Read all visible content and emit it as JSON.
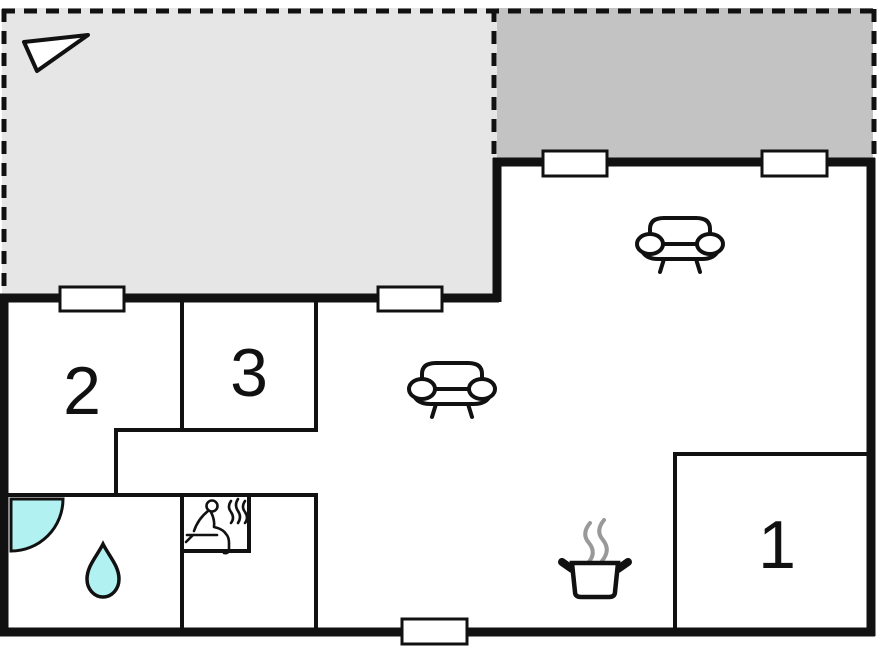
{
  "page": {
    "type": "vacation-house-floor-plan"
  },
  "rooms": [
    {
      "number": "1"
    },
    {
      "number": "2"
    },
    {
      "number": "3"
    }
  ],
  "areas": {
    "terrace_upper_left": "open terrace (light grey, dashed boundary)",
    "terrace_upper_right": "covered terrace (dark grey, dashed boundary)",
    "bathroom": "bathroom with shower and water drop symbols",
    "sauna": "sauna room with sauna bench symbol",
    "living_area": "living area with two sofas",
    "kitchen": "kitchen area with cooking pot symbol"
  },
  "icons": [
    "north-arrow-icon",
    "sofa-icon",
    "sofa-icon",
    "shower-quarter-circle-icon",
    "water-drop-icon",
    "sauna-person-icon",
    "heat-waves-icon",
    "cooking-pot-icon",
    "steam-icon"
  ],
  "counts": {
    "windows": 5
  },
  "colors": {
    "terrace_light": "#e6e6e6",
    "terrace_dark": "#c3c3c3",
    "wall": "#111111",
    "water_fill": "#b2f1f1",
    "steam": "#999999",
    "background": "#ffffff"
  }
}
